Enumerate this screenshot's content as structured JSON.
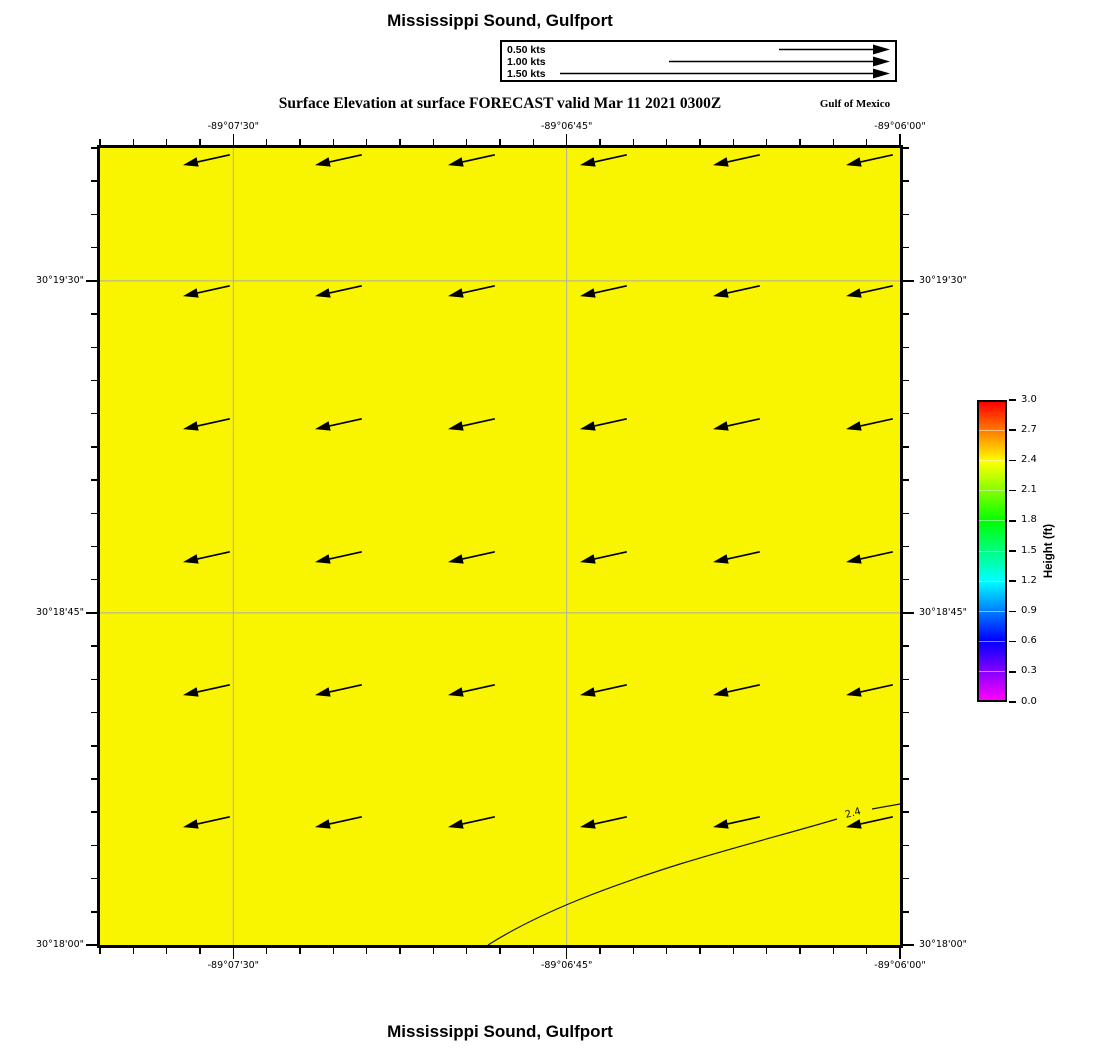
{
  "page": {
    "title_top": "Mississippi Sound, Gulfport",
    "title_bottom": "Mississippi Sound, Gulfport"
  },
  "plot": {
    "subtitle": "Surface Elevation at surface FORECAST valid Mar 11 2021 0300Z",
    "corner_label": "Gulf of Mexico",
    "contour_label": "2.4",
    "fill_color": "#F9F500",
    "gridline_color": "#ADADAD"
  },
  "legend": {
    "items": [
      {
        "label": "0.50 kts",
        "speed_kts": 0.5
      },
      {
        "label": "1.00 kts",
        "speed_kts": 1.0
      },
      {
        "label": "1.50 kts",
        "speed_kts": 1.5
      }
    ]
  },
  "axes": {
    "lon_labels": [
      "-89°07'30\"",
      "-89°06'45\"",
      "-89°06'00\""
    ],
    "lat_labels": [
      "30°19'30\"",
      "30°18'45\"",
      "30°18'00\""
    ]
  },
  "colorbar": {
    "label": "Height (ft)",
    "tick_labels": [
      "3.0",
      "2.7",
      "2.4",
      "2.1",
      "1.8",
      "1.5",
      "1.2",
      "0.9",
      "0.6",
      "0.3",
      "0.0"
    ],
    "gradient_colors_top_to_bottom": [
      "#FF0000",
      "#FF8000",
      "#FFFF00",
      "#80FF00",
      "#00FF00",
      "#00FF80",
      "#00FFFF",
      "#0080FF",
      "#0000FF",
      "#8000FF",
      "#FF00FF"
    ]
  },
  "chart_data": {
    "type": "heatmap",
    "title": "Surface Elevation at surface FORECAST valid Mar 11 2021 0300Z",
    "region": "Mississippi Sound, Gulfport",
    "area_label": "Gulf of Mexico",
    "x_axis": {
      "label": "Longitude",
      "ticks": [
        "-89°07'30\"",
        "-89°06'45\"",
        "-89°06'00\""
      ]
    },
    "y_axis": {
      "label": "Latitude",
      "ticks": [
        "30°19'30\"",
        "30°18'45\"",
        "30°18'00\""
      ]
    },
    "colorbar": {
      "label": "Height (ft)",
      "min": 0.0,
      "max": 3.0,
      "tick_step": 0.3
    },
    "field": "surface elevation height (ft), nearly uniform ~2.4 ft (yellow) across domain",
    "contours": [
      {
        "value": 2.4,
        "label": "2.4",
        "path": "enters bottom edge near longitude -89°06'52\", rises northeast, exits right edge near latitude 30°18'12\""
      }
    ],
    "current_vectors": {
      "grid_cols": 6,
      "grid_rows": 6,
      "direction": "pointing west-southwest (left, slightly down)",
      "approx_speed_kts": 0.25
    },
    "legend_speeds_kts": [
      0.5,
      1.0,
      1.5
    ],
    "valid_time": "Mar 11 2021 0300Z",
    "grid_on": true,
    "legend_position": "top-center above plot"
  }
}
